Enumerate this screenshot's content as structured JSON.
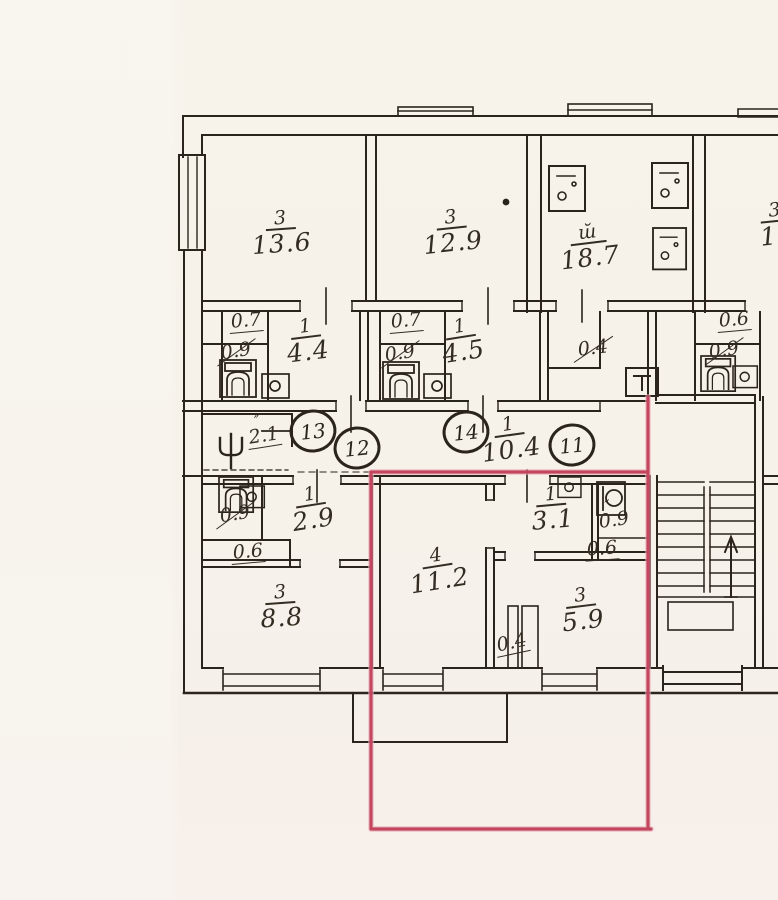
{
  "document": {
    "kind": "scanned apartment floor plan",
    "visible_title": ""
  },
  "colors": {
    "paper": "#f6f1e9",
    "ink": "#2a241c",
    "handwriting": "#332c23",
    "red_outline": "#c2465e"
  },
  "floor_plan": {
    "rooms": [
      {
        "id": "room-13-6",
        "number": "3",
        "area": "13.6",
        "x": 281,
        "y": 233,
        "rot": -4
      },
      {
        "id": "room-12-9",
        "number": "3",
        "area": "12.9",
        "x": 452,
        "y": 232,
        "rot": -6
      },
      {
        "id": "kitchen-18-7",
        "number": "ш̆",
        "area": "18.7",
        "x": 589,
        "y": 247,
        "rot": -7
      },
      {
        "id": "room-15-partial",
        "number": "3",
        "area": "15",
        "x": 776,
        "y": 225,
        "rot": -6
      },
      {
        "id": "hall-4-4",
        "number": "1",
        "area": "4.4",
        "x": 307,
        "y": 341,
        "rot": -7
      },
      {
        "id": "hall-4-5",
        "number": "1",
        "area": "4.5",
        "x": 462,
        "y": 341,
        "rot": -9
      },
      {
        "id": "corridor-10-4",
        "number": "1",
        "area": "10.4",
        "x": 510,
        "y": 439,
        "rot": -8
      },
      {
        "id": "hall-2-9",
        "number": "1",
        "area": "2.9",
        "x": 312,
        "y": 509,
        "rot": -9
      },
      {
        "id": "room-8-8",
        "number": "3",
        "area": "8.8",
        "x": 281,
        "y": 607,
        "rot": -4
      },
      {
        "id": "room-11-2",
        "number": "4",
        "area": "11.2",
        "x": 438,
        "y": 570,
        "rot": -9
      },
      {
        "id": "hall-3-1",
        "number": "1",
        "area": "3.1",
        "x": 552,
        "y": 509,
        "rot": -5
      },
      {
        "id": "room-5-9",
        "number": "3",
        "area": "5.9",
        "x": 582,
        "y": 610,
        "rot": -7
      }
    ],
    "small_labels": [
      {
        "text": "0.7",
        "x": 246,
        "y": 322,
        "rot": -5,
        "underline": true
      },
      {
        "text": "0.9",
        "x": 236,
        "y": 352,
        "rot": -9,
        "slash": true
      },
      {
        "text": "0.7",
        "x": 406,
        "y": 322,
        "rot": -5,
        "underline": true
      },
      {
        "text": "0.9",
        "x": 400,
        "y": 354,
        "rot": -9,
        "slash": true
      },
      {
        "text": "0.4",
        "x": 593,
        "y": 349,
        "rot": -7,
        "slash": true
      },
      {
        "text": "0.6",
        "x": 734,
        "y": 321,
        "rot": -5,
        "underline": true
      },
      {
        "text": "0.9",
        "x": 724,
        "y": 351,
        "rot": -9,
        "slash": true
      },
      {
        "text": "2.1",
        "x": 264,
        "y": 437,
        "rot": -9,
        "underline": true,
        "ditto": true
      },
      {
        "text": "0.9",
        "x": 235,
        "y": 515,
        "rot": -9,
        "slash": true
      },
      {
        "text": "0.6",
        "x": 248,
        "y": 553,
        "rot": -5,
        "underline": true
      },
      {
        "text": "0.9",
        "x": 614,
        "y": 521,
        "rot": -8,
        "ditto": true
      },
      {
        "text": "0.6",
        "x": 602,
        "y": 550,
        "rot": -4,
        "underline": true
      },
      {
        "text": "0.4",
        "x": 512,
        "y": 644,
        "rot": -12,
        "underline": true
      }
    ],
    "circled_numbers": [
      {
        "value": "13",
        "x": 313,
        "y": 431
      },
      {
        "value": "12",
        "x": 357,
        "y": 448
      },
      {
        "value": "14",
        "x": 466,
        "y": 432
      },
      {
        "value": "11",
        "x": 572,
        "y": 445
      }
    ],
    "icons": [
      {
        "icon": "toilet-icon",
        "x": 220,
        "y": 360
      },
      {
        "icon": "toilet-icon",
        "x": 383,
        "y": 362
      },
      {
        "icon": "toilet-icon",
        "x": 701,
        "y": 356,
        "s": 0.95
      },
      {
        "icon": "toilet-icon",
        "x": 219,
        "y": 477,
        "s": 0.95
      },
      {
        "icon": "appliance-icon",
        "x": 549,
        "y": 166
      },
      {
        "icon": "appliance-icon",
        "x": 652,
        "y": 163
      },
      {
        "icon": "appliance-icon",
        "x": 653,
        "y": 228,
        "s": 0.92
      },
      {
        "icon": "sink-icon",
        "x": 262,
        "y": 374
      },
      {
        "icon": "sink-icon",
        "x": 424,
        "y": 374
      },
      {
        "icon": "sink-icon",
        "x": 733,
        "y": 366,
        "s": 0.9
      },
      {
        "icon": "sink-icon",
        "x": 240,
        "y": 486,
        "s": 0.9
      },
      {
        "icon": "sink-icon",
        "x": 558,
        "y": 477,
        "s": 0.85
      },
      {
        "icon": "washbasin-icon",
        "x": 597,
        "y": 482
      },
      {
        "icon": "coat-rack-icon",
        "x": 214,
        "y": 426
      },
      {
        "icon": "electrical-panel-icon",
        "x": 626,
        "y": 368
      }
    ],
    "stairs": {
      "direction_arrow": "up"
    }
  }
}
